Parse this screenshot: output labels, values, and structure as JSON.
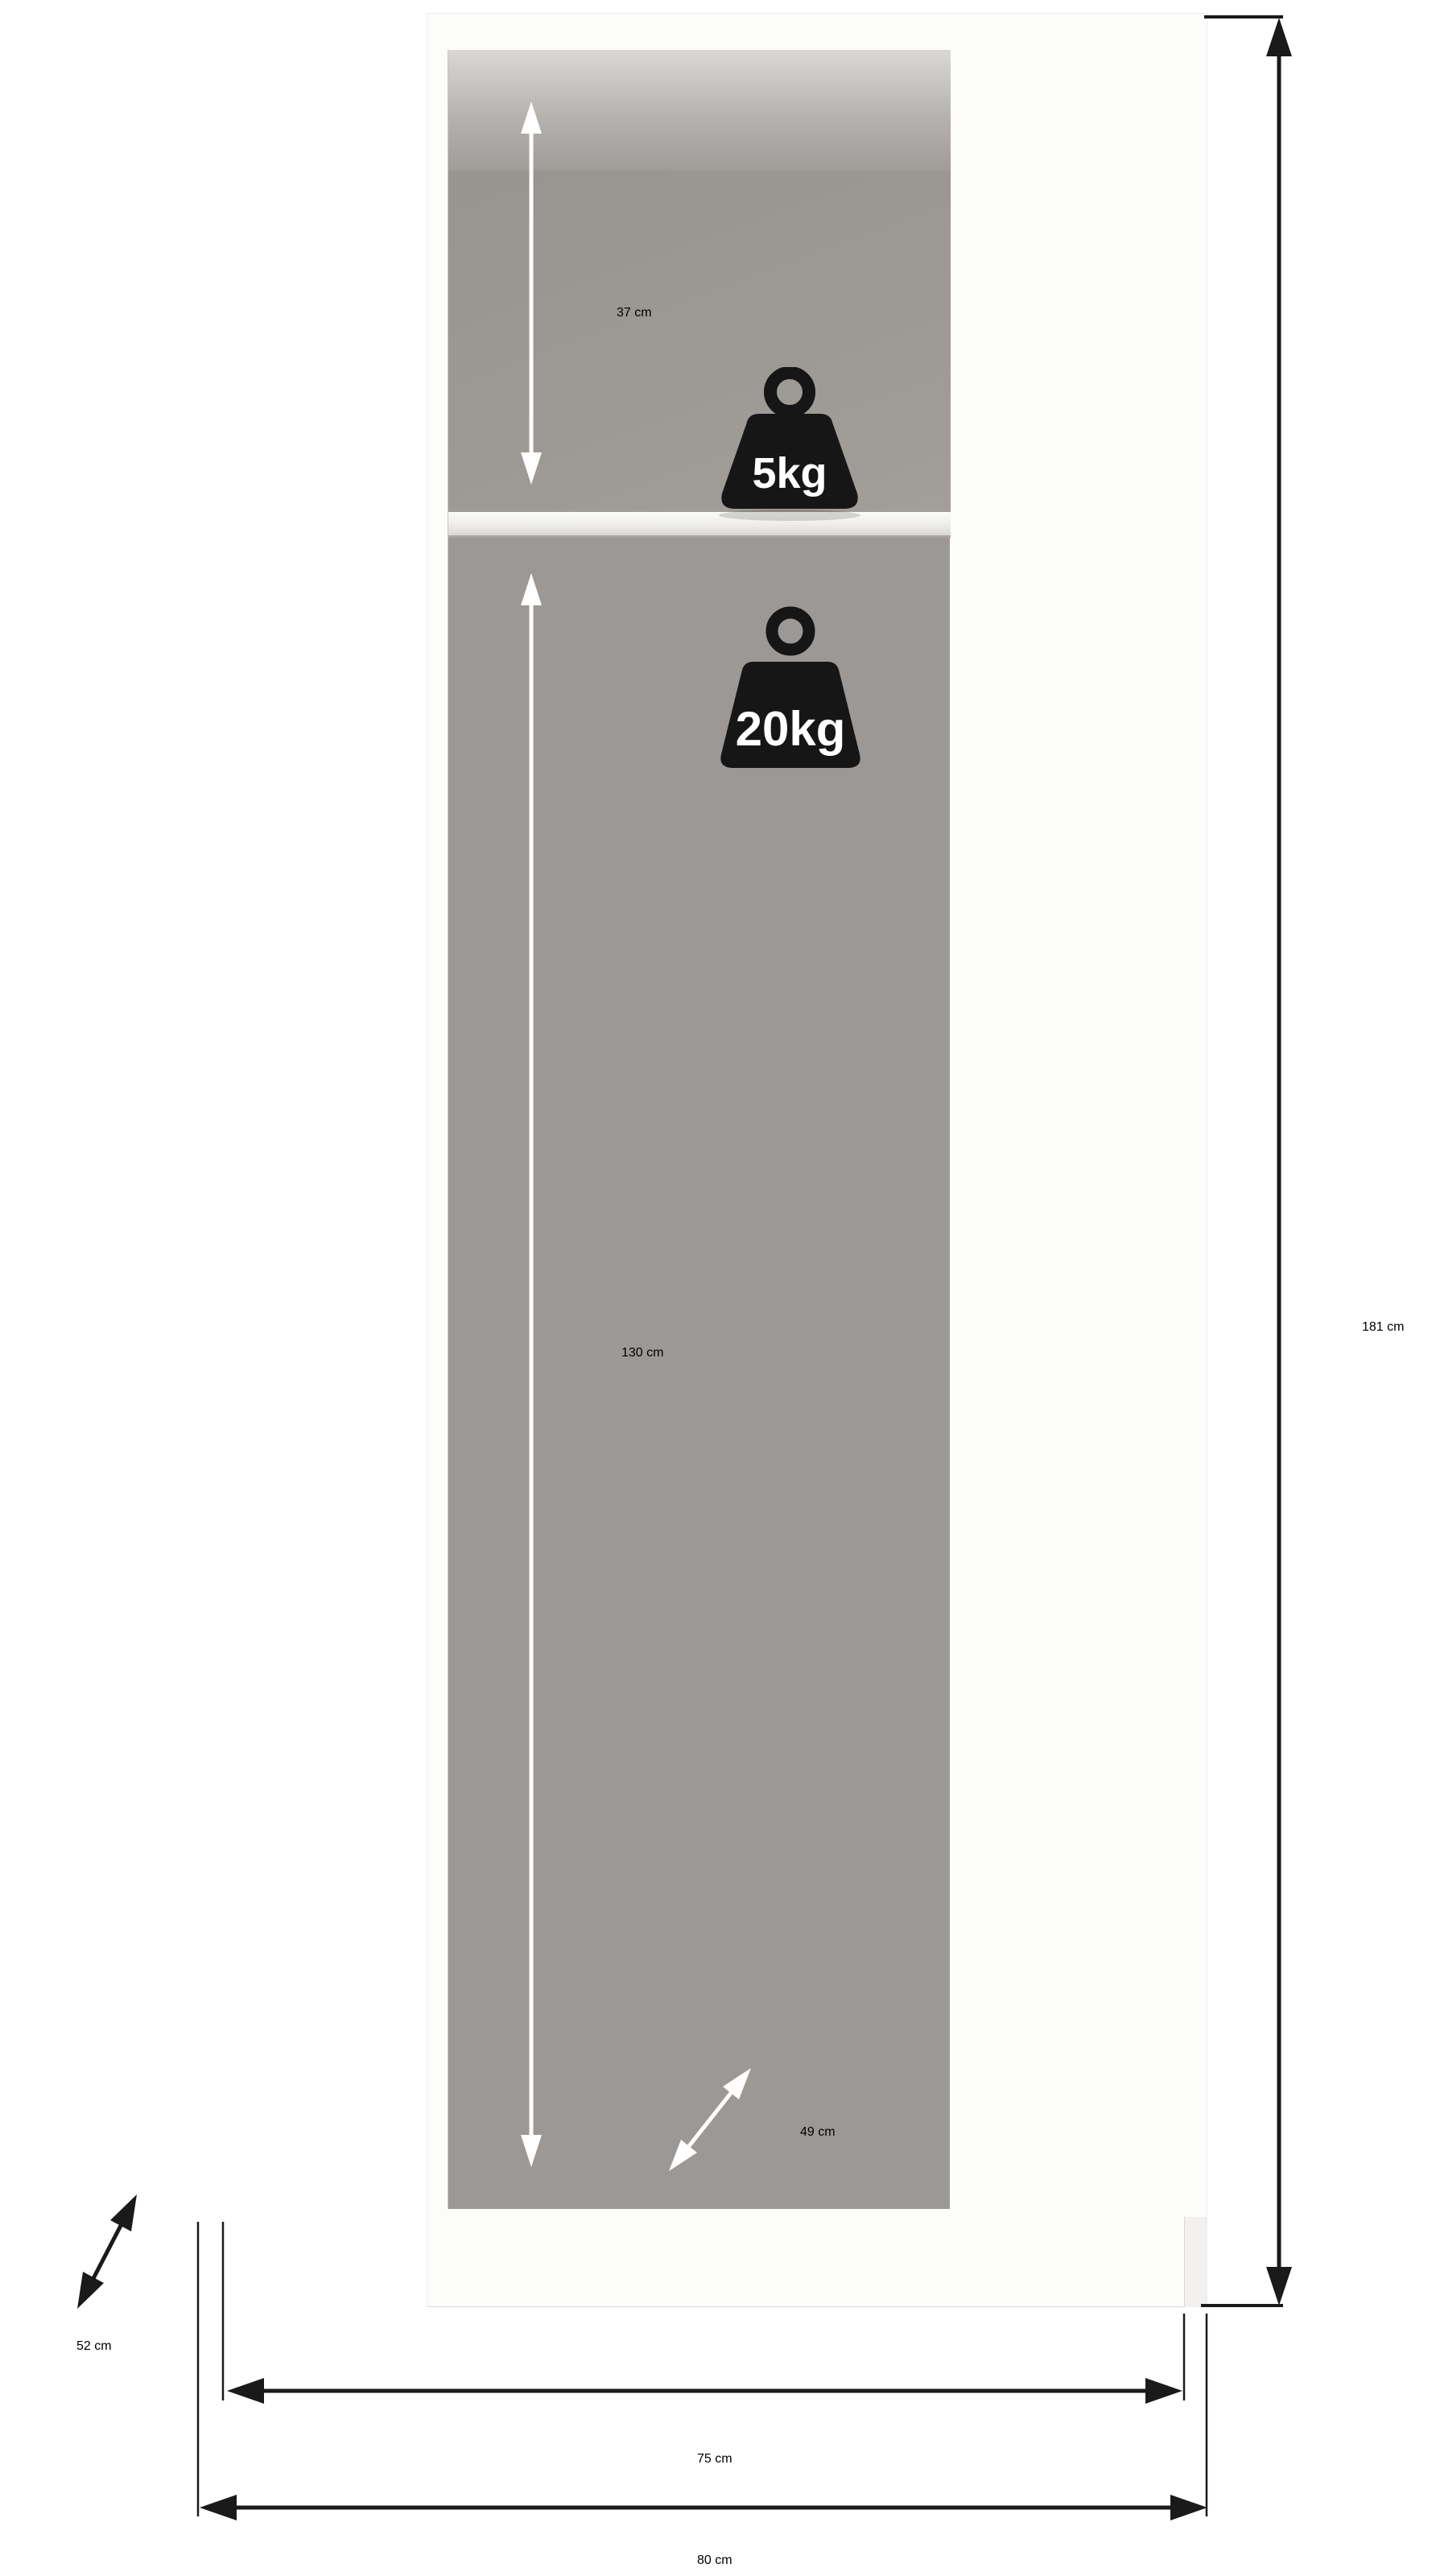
{
  "diagram": {
    "kind": "wardrobe-dimension-diagram",
    "labels": {
      "top_compartment_height": "37 cm",
      "shelf_max_load": "5kg",
      "rod_max_load": "20kg",
      "hanging_area_height": "130 cm",
      "usable_depth": "49 cm",
      "total_height": "181 cm",
      "total_depth": "52 cm",
      "interior_width": "75 cm",
      "total_width": "80 cm"
    },
    "colors": {
      "background": "#ffffff",
      "interior_gray": "#9c9895",
      "door_white": "#f6f5f3",
      "handle_black": "#1a1a1c",
      "weight_icon_black": "#161616",
      "dimension_text_dark": "#1a1a1a",
      "dimension_text_light": "#ffffff"
    }
  }
}
